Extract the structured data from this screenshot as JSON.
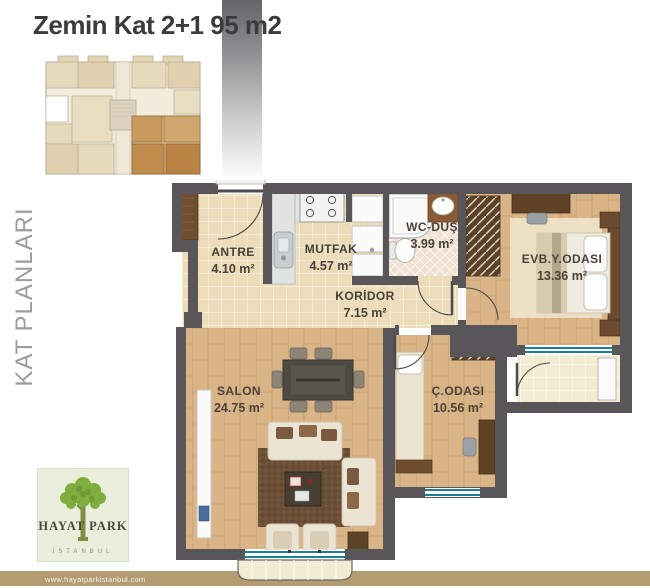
{
  "page": {
    "title": "Zemin Kat 2+1 95 m2"
  },
  "sidebar": {
    "label": "KAT PLANLARI"
  },
  "logo": {
    "name": "HAYAT PARK",
    "city": "İSTANBUL"
  },
  "footer": {
    "url": "www.hayatparkistanbul.com"
  },
  "floor_plan": {
    "unit_type": "2+1",
    "floor": "Zemin Kat",
    "total_area": "95 m2",
    "rooms": [
      {
        "name": "ANTRE",
        "area": "4.10 m²"
      },
      {
        "name": "MUTFAK",
        "area": "4.57 m²"
      },
      {
        "name": "WC-DUŞ",
        "area": "3.99 m²"
      },
      {
        "name": "KORİDOR",
        "area": "7.15 m²"
      },
      {
        "name": "EVB.Y.ODASI",
        "area": "13.36 m²"
      },
      {
        "name": "SALON",
        "area": "24.75 m²"
      },
      {
        "name": "Ç.ODASI",
        "area": "10.56 m²"
      }
    ]
  },
  "colors": {
    "wall": "#59565a",
    "tile_floor": "#ecdcba",
    "wood_floor": "#d9b486",
    "wc_floor": "#f1e1d2",
    "balcony_floor": "#f3ecd3",
    "window_glass": "#1a8095",
    "footer_bar": "#b49b72",
    "logo_green": "#7fae3e",
    "label_text": "#4a4138"
  }
}
